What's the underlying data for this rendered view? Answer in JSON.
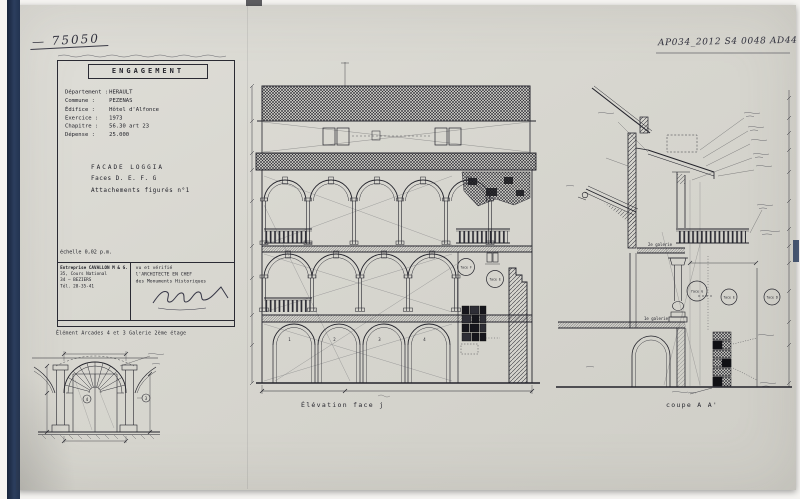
{
  "annotations": {
    "ref_left": "— 75050",
    "ref_right": "AP034_2012 S4 0048 AD44"
  },
  "title_block": {
    "title": "ENGAGEMENT",
    "fields": [
      {
        "label": "Département :",
        "value": "HERAULT"
      },
      {
        "label": "Commune :",
        "value": "PEZENAS"
      },
      {
        "label": "Édifice :",
        "value": "Hôtel d'Alfonce"
      },
      {
        "label": "Exercice :",
        "value": "1973"
      },
      {
        "label": "Chapitre :",
        "value": "56.30 art 23"
      },
      {
        "label": "Dépense :",
        "value": "25.000"
      }
    ],
    "subject_line1": "FACADE LOGGIA",
    "subject_line2": "Faces D. E. F. G",
    "subject_line3": "Attachements figurés n°1",
    "scale_note": "échelle 0,02 p.m.",
    "contractor": {
      "line1": "Entreprise CAVALLON M & G.",
      "line2": "35, Cours National",
      "line3": "34 — BEZIERS",
      "line4": "Tél. 28-35-41"
    },
    "approval": {
      "line1": "vu et vérifié",
      "line2": "l'ARCHITECTE EN CHEF",
      "line3": "des Monuments Historiques"
    }
  },
  "detail": {
    "caption": "Élément Arcades 4 et 3 Galerie 2ème étage",
    "badge_left": "4",
    "badge_right": "3"
  },
  "elevation": {
    "caption": "Élévation face j",
    "arch_numbers": [
      "1",
      "2",
      "3",
      "4"
    ],
    "face_label_1": "face F",
    "face_label_2": "face E"
  },
  "section": {
    "caption": "coupe A A'",
    "gallery_label_upper": "2e galerie",
    "gallery_label_lower": "1e galerie",
    "face_label_1": "face G",
    "face_label_2": "face E",
    "face_label_3": "face D"
  },
  "colors": {
    "paper": "#d8d7d0",
    "ink": "#23232b",
    "binding_blue": "#2c3e5e"
  }
}
